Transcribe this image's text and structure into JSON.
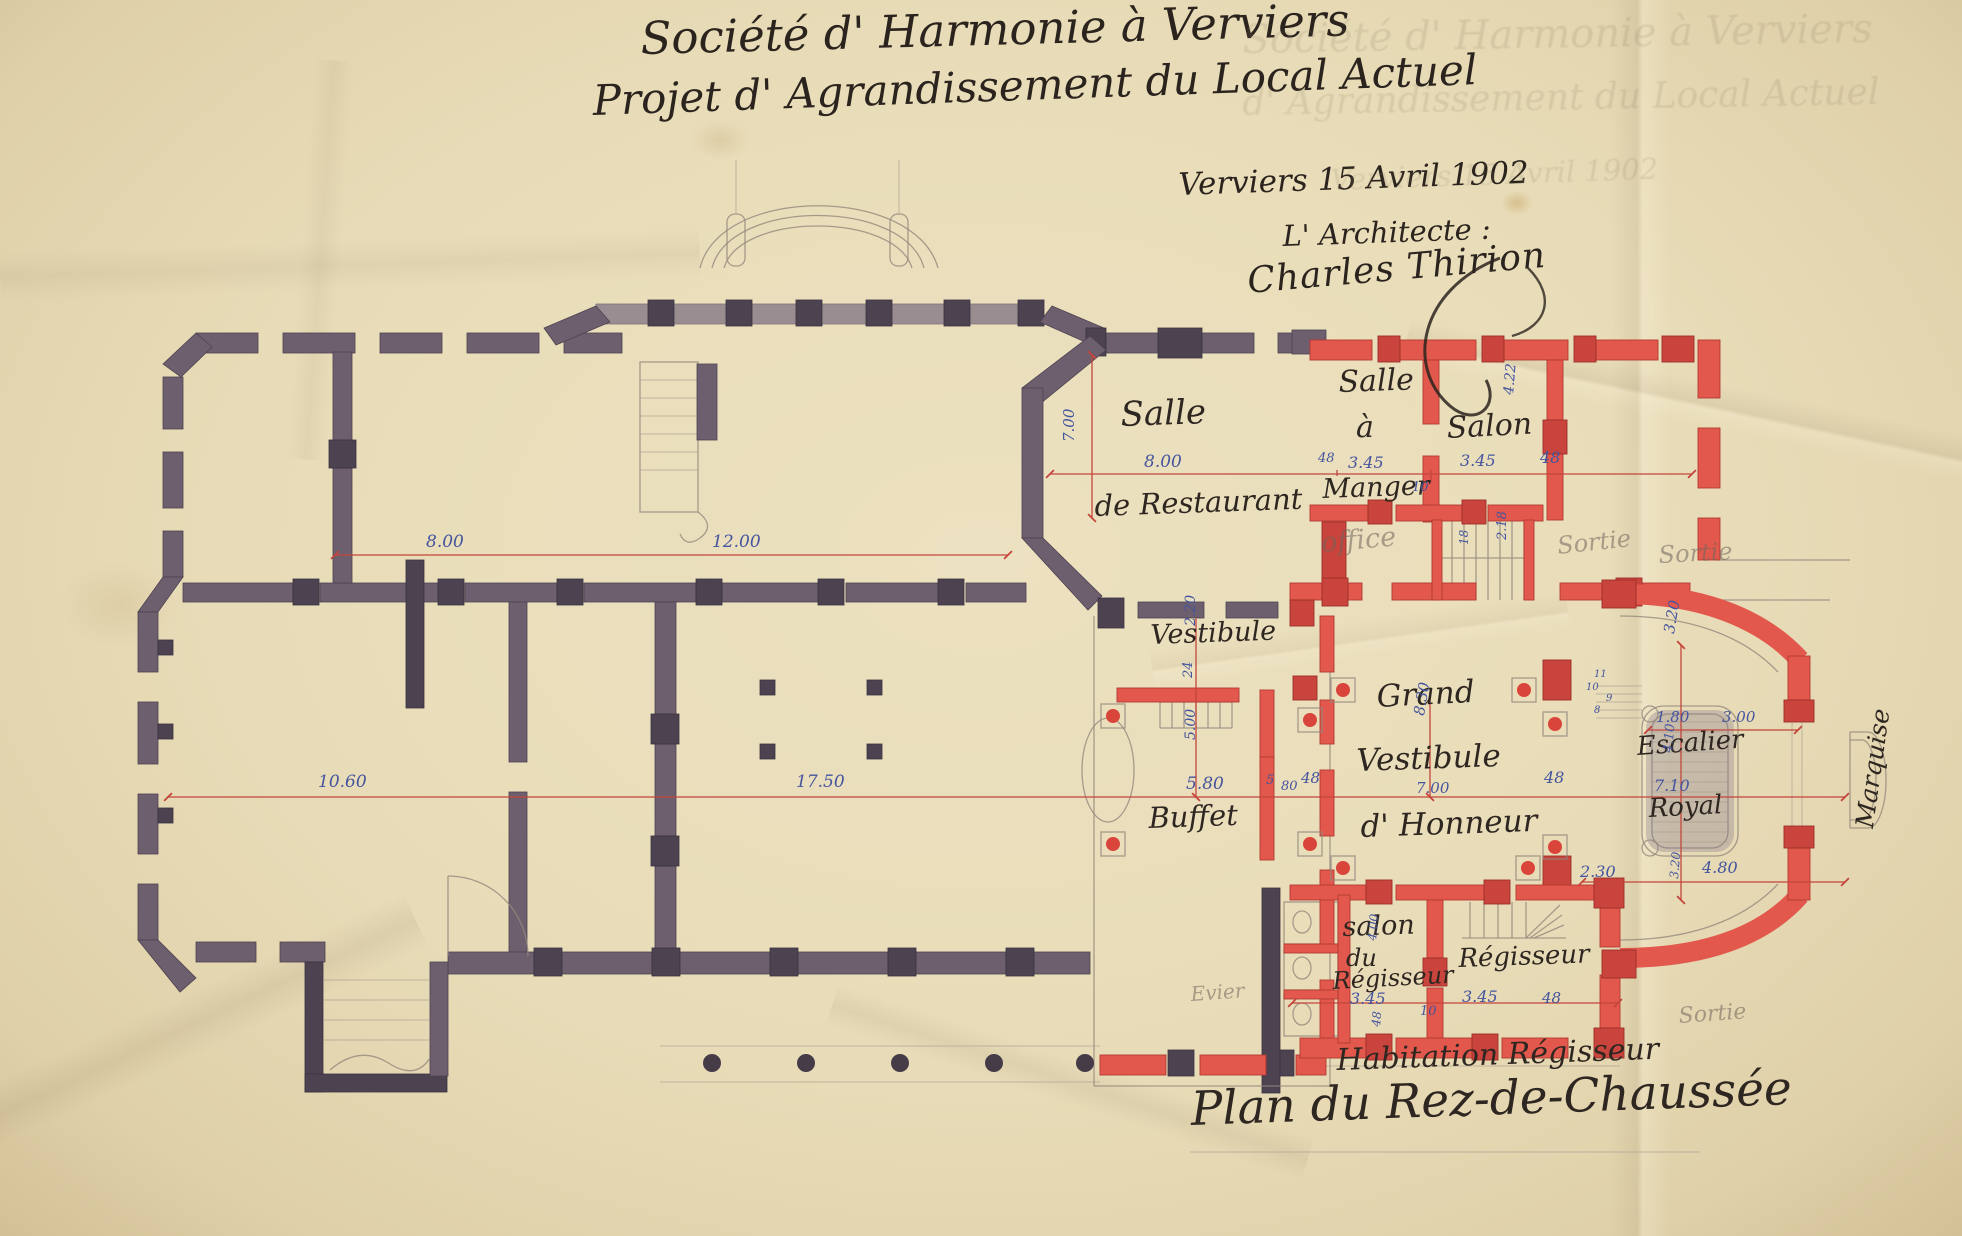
{
  "document": {
    "title_line1": "Société d' Harmonie à Verviers",
    "title_line2": "Projet d' Agrandissement du Local Actuel",
    "place_date": "Verviers 15 Avril 1902",
    "architect_label": "L' Architecte :",
    "signature": "Charles Thirion"
  },
  "colors": {
    "paper": "#e8dcb8",
    "existing_walls_grey": "#6e5f6e",
    "new_walls_red": "#e2584c",
    "red_ink_lines": "#c4453c",
    "blue_ink_dimensions": "#44549e",
    "black_ink": "#2e2620",
    "pencil": "#94887d"
  },
  "labels": [
    {
      "n": "ghost-title-line1",
      "t": "Société d' Harmonie à Verviers",
      "x": 1242,
      "y": 20,
      "s": 40,
      "c": "ghost",
      "r": -1
    },
    {
      "n": "ghost-title-line2",
      "t": "d' Agrandissement du Local Actuel",
      "x": 1242,
      "y": 86,
      "s": 36,
      "c": "ghost",
      "r": -1
    },
    {
      "n": "ghost-date-line",
      "t": "Verviers 15 Avril 1902",
      "x": 1330,
      "y": 166,
      "s": 29,
      "c": "ghost",
      "r": -2
    },
    {
      "n": "room-salle-restaurant-line1",
      "t": "Salle",
      "x": 1120,
      "y": 398,
      "s": 34,
      "c": "ink",
      "r": -2
    },
    {
      "n": "room-salle-restaurant-line2",
      "t": "de Restaurant",
      "x": 1094,
      "y": 492,
      "s": 29,
      "c": "ink",
      "r": -2
    },
    {
      "n": "room-salle-a-manger-line1",
      "t": "Salle",
      "x": 1338,
      "y": 368,
      "s": 30,
      "c": "ink",
      "r": -2
    },
    {
      "n": "room-salle-a-manger-line2",
      "t": "à",
      "x": 1356,
      "y": 413,
      "s": 30,
      "c": "ink",
      "r": 0
    },
    {
      "n": "room-salle-a-manger-line3",
      "t": "Manger",
      "x": 1322,
      "y": 476,
      "s": 27,
      "c": "ink",
      "r": -2
    },
    {
      "n": "room-salon",
      "t": "Salon",
      "x": 1446,
      "y": 414,
      "s": 30,
      "c": "ink",
      "r": -3
    },
    {
      "n": "room-vestibule",
      "t": "Vestibule",
      "x": 1150,
      "y": 622,
      "s": 27,
      "c": "ink",
      "r": -2
    },
    {
      "n": "room-grand-vestibule-line1",
      "t": "Grand",
      "x": 1376,
      "y": 682,
      "s": 31,
      "c": "ink",
      "r": -3
    },
    {
      "n": "room-grand-vestibule-line2",
      "t": "Vestibule",
      "x": 1356,
      "y": 746,
      "s": 31,
      "c": "ink",
      "r": -2
    },
    {
      "n": "room-grand-vestibule-line3",
      "t": "d' Honneur",
      "x": 1360,
      "y": 812,
      "s": 31,
      "c": "ink",
      "r": -2
    },
    {
      "n": "room-buffet",
      "t": "Buffet",
      "x": 1148,
      "y": 804,
      "s": 29,
      "c": "ink",
      "r": -2
    },
    {
      "n": "room-escalier-line1",
      "t": "Escalier",
      "x": 1636,
      "y": 734,
      "s": 26,
      "c": "ink",
      "r": -4
    },
    {
      "n": "room-escalier-line2",
      "t": "Royal",
      "x": 1648,
      "y": 796,
      "s": 26,
      "c": "ink",
      "r": -3
    },
    {
      "n": "room-marquise",
      "t": "Marquise",
      "x": 1852,
      "y": 826,
      "s": 25,
      "c": "ink",
      "r": -82
    },
    {
      "n": "room-salon-regisseur-line1",
      "t": "salon",
      "x": 1342,
      "y": 914,
      "s": 27,
      "c": "ink",
      "r": -2
    },
    {
      "n": "room-salon-regisseur-line2",
      "t": "du",
      "x": 1346,
      "y": 946,
      "s": 24,
      "c": "ink",
      "r": 0
    },
    {
      "n": "room-salon-regisseur-line3",
      "t": "Régisseur",
      "x": 1332,
      "y": 969,
      "s": 24,
      "c": "ink",
      "r": -3
    },
    {
      "n": "room-regisseur",
      "t": "Régisseur",
      "x": 1458,
      "y": 946,
      "s": 26,
      "c": "ink",
      "r": -2
    },
    {
      "n": "caption-habitation",
      "t": "Habitation Régisseur",
      "x": 1336,
      "y": 1046,
      "s": 30,
      "c": "ink",
      "r": -2
    },
    {
      "n": "caption-plan-title",
      "t": "Plan du Rez-de-Chaussée",
      "x": 1190,
      "y": 1086,
      "s": 47,
      "c": "ink",
      "r": -2
    },
    {
      "n": "dim-8-00-left",
      "t": "8.00",
      "x": 426,
      "y": 534,
      "s": 17,
      "c": "blue"
    },
    {
      "n": "dim-12-00",
      "t": "12.00",
      "x": 712,
      "y": 534,
      "s": 17,
      "c": "blue"
    },
    {
      "n": "dim-10-60",
      "t": "10.60",
      "x": 318,
      "y": 774,
      "s": 17,
      "c": "blue"
    },
    {
      "n": "dim-17-50",
      "t": "17.50",
      "x": 796,
      "y": 774,
      "s": 17,
      "c": "blue"
    },
    {
      "n": "dim-7-00-restaurant",
      "t": "7.00",
      "x": 1062,
      "y": 442,
      "s": 15,
      "c": "blue",
      "r": -90
    },
    {
      "n": "dim-8-00-restaurant",
      "t": "8.00",
      "x": 1144,
      "y": 454,
      "s": 17,
      "c": "blue"
    },
    {
      "n": "dim-48-a",
      "t": "48",
      "x": 1318,
      "y": 452,
      "s": 13,
      "c": "blue"
    },
    {
      "n": "dim-3-45-manger",
      "t": "3.45",
      "x": 1348,
      "y": 455,
      "s": 16,
      "c": "blue"
    },
    {
      "n": "dim-3-45-salon",
      "t": "3.45",
      "x": 1460,
      "y": 453,
      "s": 16,
      "c": "blue"
    },
    {
      "n": "dim-48-b",
      "t": "48",
      "x": 1540,
      "y": 450,
      "s": 16,
      "c": "blue"
    },
    {
      "n": "dim-10-a",
      "t": "10",
      "x": 1412,
      "y": 481,
      "s": 13,
      "c": "blue"
    },
    {
      "n": "dim-4-22",
      "t": "4.22",
      "x": 1502,
      "y": 394,
      "s": 14,
      "c": "blue",
      "r": -85
    },
    {
      "n": "dim-2-20",
      "t": "2.20",
      "x": 1184,
      "y": 626,
      "s": 14,
      "c": "blue",
      "r": -90
    },
    {
      "n": "dim-24",
      "t": "24",
      "x": 1182,
      "y": 678,
      "s": 13,
      "c": "blue",
      "r": -90
    },
    {
      "n": "dim-5-00",
      "t": "5.00",
      "x": 1184,
      "y": 740,
      "s": 14,
      "c": "blue",
      "r": -90
    },
    {
      "n": "dim-5-80",
      "t": "5.80",
      "x": 1186,
      "y": 776,
      "s": 17,
      "c": "blue"
    },
    {
      "n": "dim-5",
      "t": "5",
      "x": 1266,
      "y": 774,
      "s": 13,
      "c": "blue"
    },
    {
      "n": "dim-80",
      "t": "80",
      "x": 1281,
      "y": 780,
      "s": 13,
      "c": "blue"
    },
    {
      "n": "dim-48-c",
      "t": "48",
      "x": 1301,
      "y": 771,
      "s": 15,
      "c": "blue"
    },
    {
      "n": "dim-8-30",
      "t": "8.30",
      "x": 1412,
      "y": 714,
      "s": 15,
      "c": "blue",
      "r": -80
    },
    {
      "n": "dim-7-00-vestibule",
      "t": "7.00",
      "x": 1416,
      "y": 781,
      "s": 15,
      "c": "blue"
    },
    {
      "n": "dim-48-d",
      "t": "48",
      "x": 1544,
      "y": 770,
      "s": 16,
      "c": "blue"
    },
    {
      "n": "dim-18",
      "t": "18",
      "x": 1458,
      "y": 545,
      "s": 12,
      "c": "blue",
      "r": -90
    },
    {
      "n": "dim-2-18",
      "t": "2.18",
      "x": 1496,
      "y": 540,
      "s": 13,
      "c": "blue",
      "r": -90
    },
    {
      "n": "dim-3-20-top",
      "t": "3.20",
      "x": 1662,
      "y": 632,
      "s": 15,
      "c": "blue",
      "r": -80
    },
    {
      "n": "dim-1-80",
      "t": "1.80",
      "x": 1656,
      "y": 710,
      "s": 15,
      "c": "blue"
    },
    {
      "n": "dim-3-00",
      "t": "3.00",
      "x": 1722,
      "y": 710,
      "s": 15,
      "c": "blue"
    },
    {
      "n": "dim-4-10",
      "t": "4.10",
      "x": 1662,
      "y": 752,
      "s": 13,
      "c": "blue",
      "r": -85
    },
    {
      "n": "dim-7-10",
      "t": "7.10",
      "x": 1654,
      "y": 778,
      "s": 16,
      "c": "blue"
    },
    {
      "n": "dim-2-30",
      "t": "2.30",
      "x": 1580,
      "y": 864,
      "s": 16,
      "c": "blue"
    },
    {
      "n": "dim-4-80",
      "t": "4.80",
      "x": 1702,
      "y": 860,
      "s": 16,
      "c": "blue"
    },
    {
      "n": "dim-3-20-bottom",
      "t": "3.20",
      "x": 1668,
      "y": 878,
      "s": 12,
      "c": "blue",
      "r": -85
    },
    {
      "n": "dim-3-45-salon-regisseur",
      "t": "3.45",
      "x": 1350,
      "y": 991,
      "s": 16,
      "c": "blue"
    },
    {
      "n": "dim-3-45-regisseur",
      "t": "3.45",
      "x": 1462,
      "y": 989,
      "s": 16,
      "c": "blue"
    },
    {
      "n": "dim-48-e",
      "t": "48",
      "x": 1542,
      "y": 991,
      "s": 15,
      "c": "blue"
    },
    {
      "n": "dim-10-b",
      "t": "10",
      "x": 1420,
      "y": 1005,
      "s": 13,
      "c": "blue"
    },
    {
      "n": "dim-4-00",
      "t": "4.00",
      "x": 1366,
      "y": 940,
      "s": 12,
      "c": "blue",
      "r": -85
    },
    {
      "n": "dim-48-f",
      "t": "48",
      "x": 1370,
      "y": 1026,
      "s": 12,
      "c": "blue",
      "r": -85
    },
    {
      "n": "step-num-11",
      "t": "11",
      "x": 1594,
      "y": 670,
      "s": 10,
      "c": "blue"
    },
    {
      "n": "step-num-10",
      "t": "10",
      "x": 1586,
      "y": 683,
      "s": 10,
      "c": "blue"
    },
    {
      "n": "step-num-9",
      "t": "9",
      "x": 1606,
      "y": 694,
      "s": 10,
      "c": "blue"
    },
    {
      "n": "step-num-8",
      "t": "8",
      "x": 1594,
      "y": 706,
      "s": 10,
      "c": "blue"
    },
    {
      "n": "pencil-note-office",
      "t": "office",
      "x": 1320,
      "y": 530,
      "s": 27,
      "c": "pencil",
      "r": -5
    },
    {
      "n": "pencil-note-sortie-1",
      "t": "Sortie",
      "x": 1556,
      "y": 534,
      "s": 24,
      "c": "pencil",
      "r": -6
    },
    {
      "n": "pencil-note-sortie-2",
      "t": "Sortie",
      "x": 1658,
      "y": 543,
      "s": 24,
      "c": "pencil",
      "r": -3
    },
    {
      "n": "pencil-note-sortie-3",
      "t": "Sortie",
      "x": 1678,
      "y": 1006,
      "s": 22,
      "c": "pencil",
      "r": -4
    },
    {
      "n": "pencil-note-evier",
      "t": "Evier",
      "x": 1190,
      "y": 984,
      "s": 20,
      "c": "pencil",
      "r": -4
    }
  ]
}
